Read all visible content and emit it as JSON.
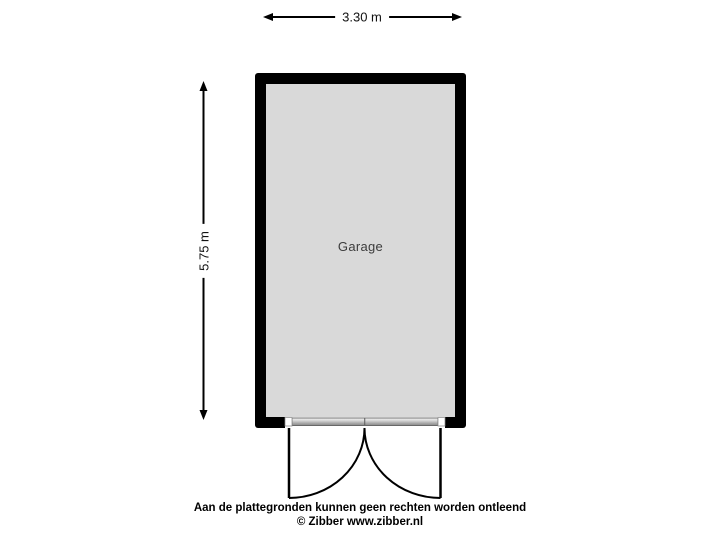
{
  "floorplan": {
    "room_label": "Garage",
    "width_dimension": "3.30 m",
    "height_dimension": "5.75 m"
  },
  "footer": {
    "disclaimer": "Aan de plattegronden kunnen geen rechten worden ontleend",
    "copyright": "© Zibber www.zibber.nl"
  },
  "icons": {
    "door_swing": "double-outward-swing-doors"
  },
  "colors": {
    "background": "#ffffff",
    "wall": "#000000",
    "floor_fill": "#d9d9d9",
    "room_label_text": "#3c3c3c",
    "dimension_text": "#111111",
    "footer_text": "#000000"
  }
}
